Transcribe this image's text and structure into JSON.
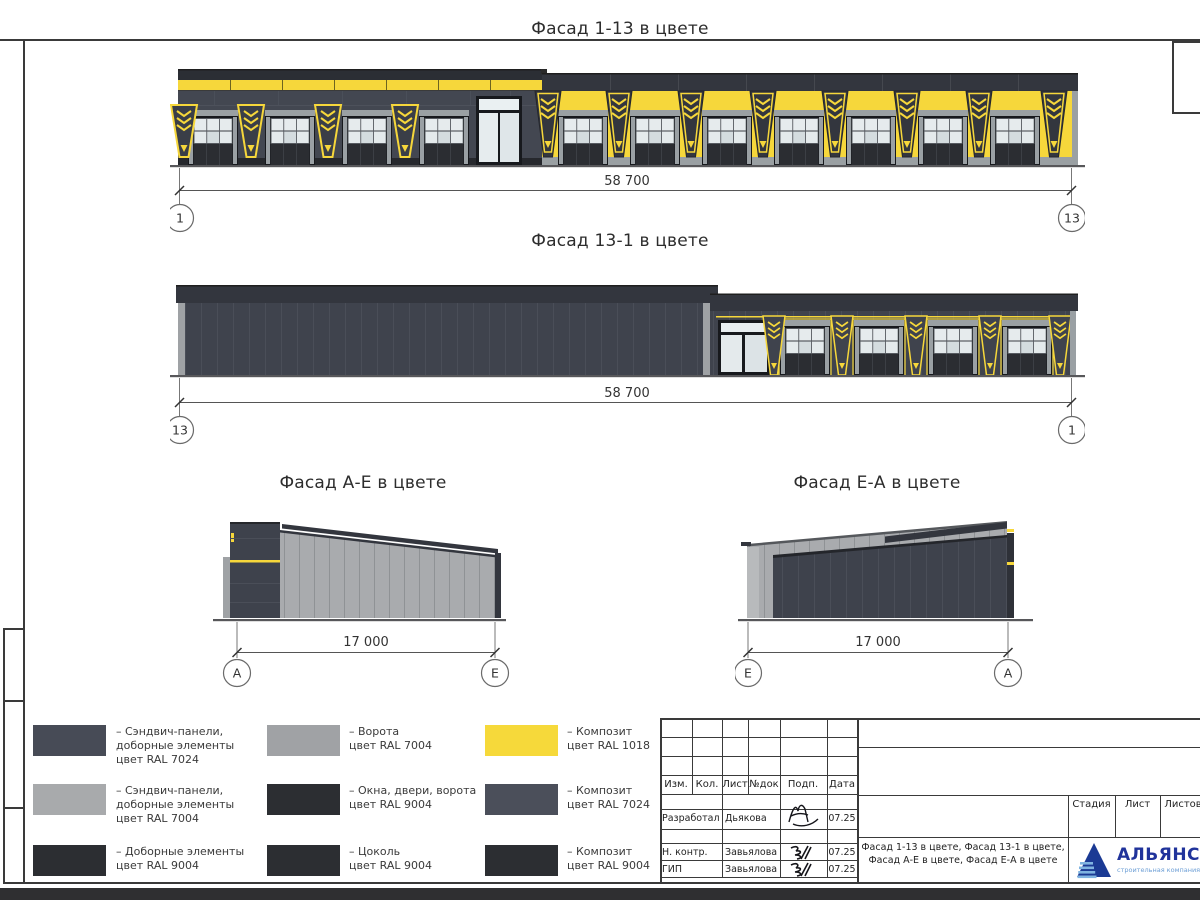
{
  "colors": {
    "yellow_ral1018": "#f6d73b",
    "dark_gray_ral7024": "#41454f",
    "light_gray_ral7004": "#a7a9ac",
    "near_black_ral9004": "#26282d",
    "logo_blue": "#20339b",
    "logo_light_blue": "#6d9fd6"
  },
  "facades": {
    "f1": {
      "title": "Фасад 1-13 в цвете",
      "dim": "58 700",
      "axis_left": "1",
      "axis_right": "13"
    },
    "f2": {
      "title": "Фасад 13-1 в цвете",
      "dim": "58 700",
      "axis_left": "13",
      "axis_right": "1"
    },
    "f3": {
      "title": "Фасад А-Е в цвете",
      "dim": "17 000",
      "axis_left": "А",
      "axis_right": "Е"
    },
    "f4": {
      "title": "Фасад Е-А в цвете",
      "dim": "17 000",
      "axis_left": "Е",
      "axis_right": "А"
    }
  },
  "legend": {
    "items": [
      {
        "color": "#474b56",
        "label": "– Сэндвич-панели,\nдоборные элементы\nцвет RAL 7024"
      },
      {
        "color": "#a8aaac",
        "label": "– Сэндвич-панели,\nдоборные элементы\nцвет RAL 7004"
      },
      {
        "color": "#2c2e32",
        "label": "– Доборные элементы\nцвет RAL 9004"
      },
      {
        "color": "#a0a2a5",
        "label": "– Ворота\nцвет RAL 7004"
      },
      {
        "color": "#2c2e32",
        "label": "– Окна, двери, ворота\nцвет RAL 9004"
      },
      {
        "color": "#2c2e32",
        "label": "– Цоколь\nцвет RAL 9004"
      },
      {
        "color": "#f6d93a",
        "label": "– Композит\nцвет RAL 1018"
      },
      {
        "color": "#4b4f5a",
        "label": "– Композит\nцвет RAL 7024"
      },
      {
        "color": "#2c2e32",
        "label": "– Композит\nцвет RAL 9004"
      }
    ]
  },
  "title_block": {
    "cols": {
      "c0": "Изм.",
      "c1": "Кол.",
      "c2": "Лист",
      "c3": "№док",
      "c4": "Подп.",
      "c5": "Дата"
    },
    "rows": [
      {
        "role": "Разработал",
        "name": "Дьякова",
        "date": "07.25"
      },
      {
        "role": "Н. контр.",
        "name": "Завьялова",
        "date": "07.25"
      },
      {
        "role": "ГИП",
        "name": "Завьялова",
        "date": "07.25"
      }
    ],
    "stage_label": "Стадия",
    "sheet_label": "Лист",
    "sheets_label": "Листов",
    "doc_title": "Фасад 1-13 в цвете, Фасад 13-1 в цвете, Фасад А-Е в цвете, Фасад Е-А в цвете",
    "logo_name": "АЛЬЯНС",
    "logo_tagline": "строительная компания"
  }
}
